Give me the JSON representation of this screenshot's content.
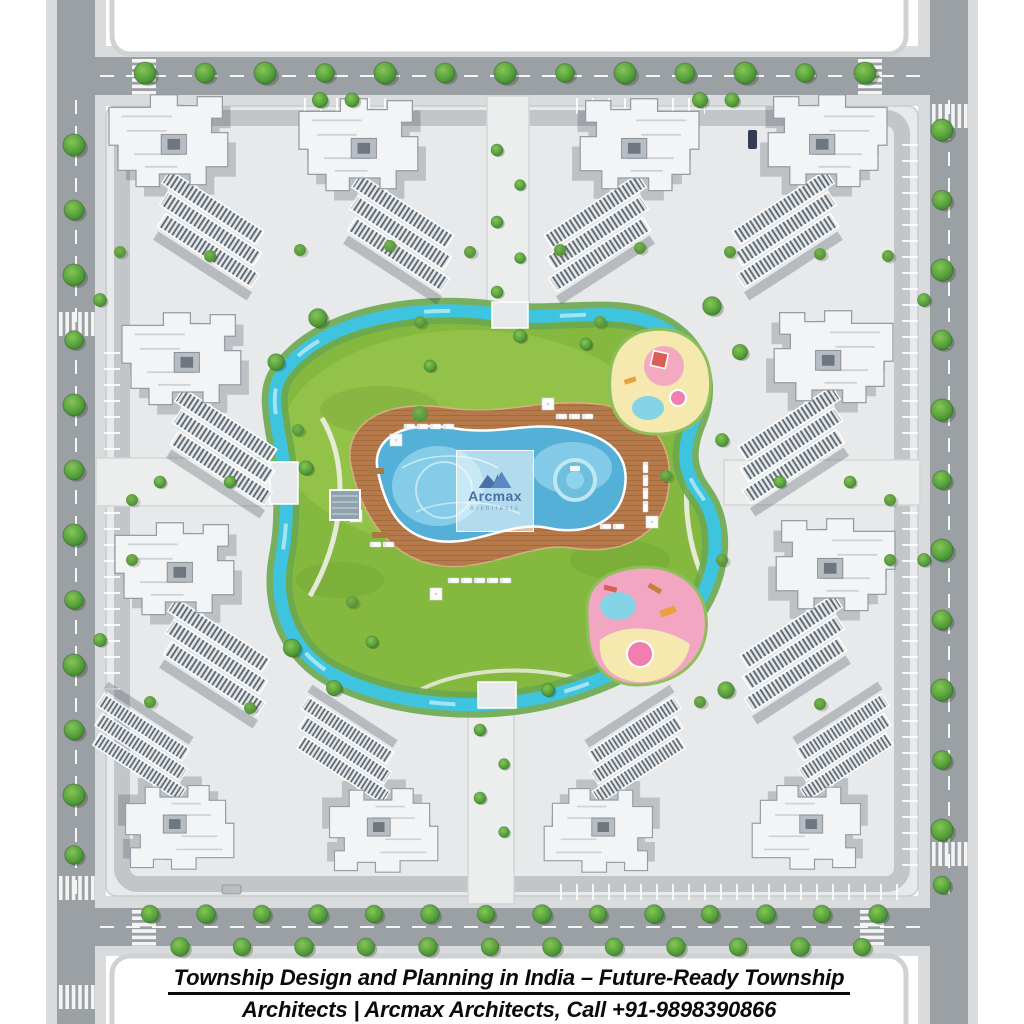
{
  "caption": {
    "line1": "Township Design and Planning in India – Future-Ready Township",
    "line2": "Architects | Arcmax Architects, Call +91-9898390866"
  },
  "watermark": {
    "brand": "Arcmax",
    "subtitle": "Architects"
  },
  "colors": {
    "road": "#9aa0a4",
    "sidewalk": "#d9dbdc",
    "pavement": "#e7e9ea",
    "inner_drive": "#c2c6c9",
    "parcel": "#ffffff",
    "lawn": "#85b83e",
    "bush_band": "#6aa84f",
    "river": "#3fc4e0",
    "river_highlight": "#a9e6f2",
    "pool_water": "#55b0d8",
    "pool_water_light": "#8ed1ec",
    "pool_deck": "#b5794a",
    "spa": "#6ebede",
    "playground_yellow": "#f5e9af",
    "playground_pink": "#f2a6c2",
    "playground_blue": "#85d4e6",
    "equipment_red": "#d95f54",
    "equipment_orange": "#e9a13b",
    "building_roof": "#f2f4f6",
    "facade_stripe": "#5d6770",
    "watermark_blue": "#4a6fa3",
    "watermark_gray": "#7b92ad",
    "caption_text": "#0a0a0a"
  }
}
